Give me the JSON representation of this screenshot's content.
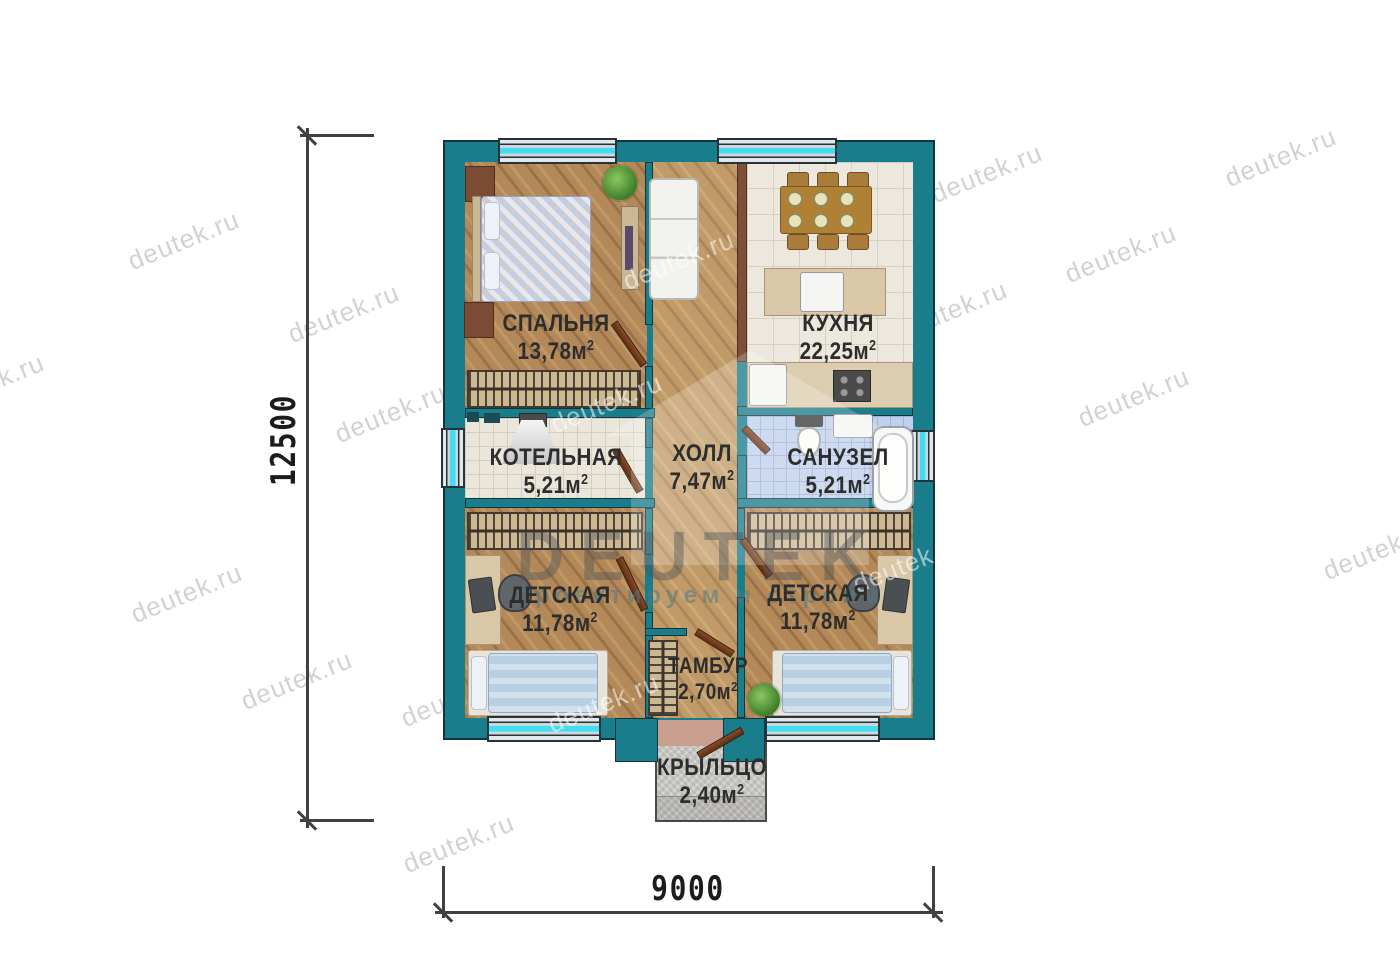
{
  "title": "Floor plan with DEUTEK watermark",
  "watermark": {
    "text": "deutek.ru"
  },
  "logo": {
    "name": "DEUTEK",
    "tagline": "проектируем и строим"
  },
  "dimensions": {
    "height": "12500",
    "width": "9000"
  },
  "units": {
    "sup": "2"
  },
  "rooms": [
    {
      "id": "bedroom",
      "label": "СПАЛЬНЯ",
      "area": "13,78м"
    },
    {
      "id": "kitchen",
      "label": "КУХНЯ",
      "area": "22,25м"
    },
    {
      "id": "boiler",
      "label": "КОТЕЛЬНАЯ",
      "area": "5,21м"
    },
    {
      "id": "hall",
      "label": "ХОЛЛ",
      "area": "7,47м"
    },
    {
      "id": "bathroom",
      "label": "САНУЗЕЛ",
      "area": "5,21м"
    },
    {
      "id": "kids-left",
      "label": "ДЕТСКАЯ",
      "area": "11,78м"
    },
    {
      "id": "kids-right",
      "label": "ДЕТСКАЯ",
      "area": "11,78м"
    },
    {
      "id": "vestibule",
      "label": "ТАМБУР",
      "area": "2,70м"
    },
    {
      "id": "porch",
      "label": "КРЫЛЬЦО",
      "area": "2,40м"
    }
  ],
  "colors": {
    "wall_teal": "#1a7d8c",
    "wall_outline": "#15333c",
    "window_glass": "#3fdef2",
    "wood_floor": "#b3895a",
    "kitchen_tile": "#ece8de",
    "bath_tile": "#bfd0ec",
    "porch_concrete": "#c8c6c2",
    "door_leaf": "#6e3c22",
    "label_text": "#2d2d2d",
    "dimension_line": "#3f4245",
    "watermark_gray": "#d2d2d2"
  }
}
